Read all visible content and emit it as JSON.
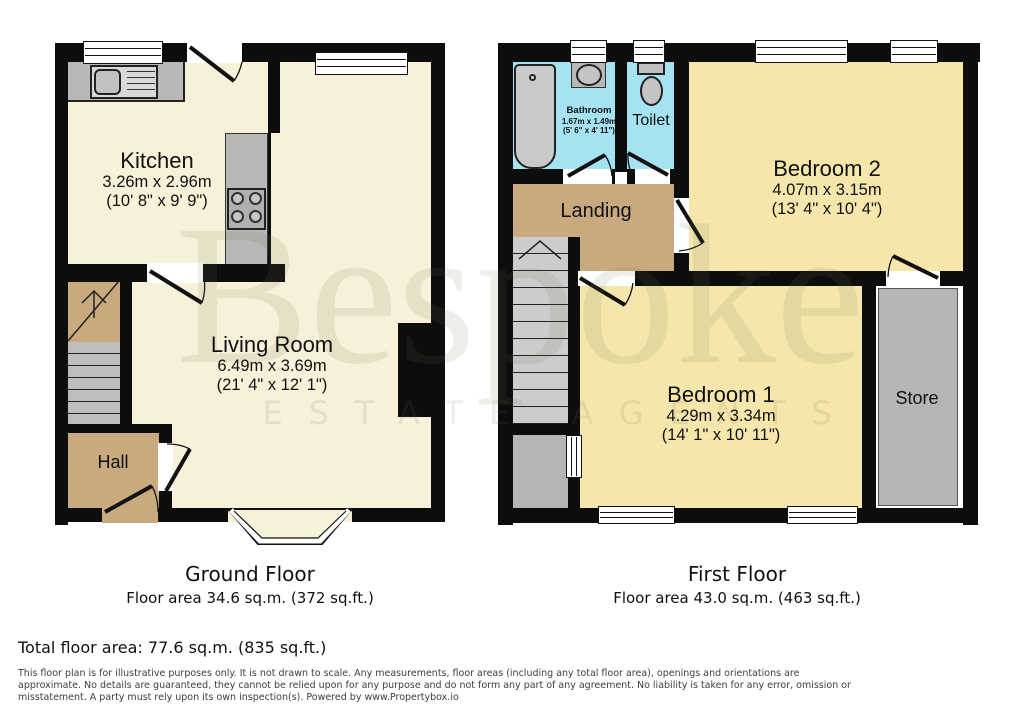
{
  "watermark": {
    "brand": "Bespoke",
    "tagline": "ESTATE AGENTS"
  },
  "ground_floor": {
    "title": "Ground Floor",
    "area": "Floor area 34.6 sq.m. (372 sq.ft.)",
    "rooms": {
      "kitchen": {
        "name": "Kitchen",
        "dim_m": "3.26m x 2.96m",
        "dim_ft": "(10' 8\" x 9' 9\")"
      },
      "living": {
        "name": "Living Room",
        "dim_m": "6.49m x 3.69m",
        "dim_ft": "(21' 4\" x 12' 1\")"
      },
      "hall": {
        "name": "Hall"
      }
    }
  },
  "first_floor": {
    "title": "First Floor",
    "area": "Floor area 43.0 sq.m. (463 sq.ft.)",
    "rooms": {
      "bathroom": {
        "name": "Bathroom",
        "dim_m": "1.67m x 1.49m",
        "dim_ft": "(5' 6\" x 4' 11\")"
      },
      "toilet": {
        "name": "Toilet"
      },
      "landing": {
        "name": "Landing"
      },
      "bedroom2": {
        "name": "Bedroom 2",
        "dim_m": "4.07m x 3.15m",
        "dim_ft": "(13' 4\" x 10' 4\")"
      },
      "bedroom1": {
        "name": "Bedroom 1",
        "dim_m": "4.29m x 3.34m",
        "dim_ft": "(14' 1\" x 10' 11\")"
      },
      "store": {
        "name": "Store"
      }
    }
  },
  "summary": {
    "total": "Total floor area: 77.6 sq.m. (835 sq.ft.)"
  },
  "disclaimer_lines": [
    "This floor plan is for illustrative purposes only. It is not drawn to scale. Any measurements, floor areas (including any total floor area), openings and orientations are",
    "approximate. No details are guaranteed, they cannot be relied upon for any purpose and do not form any part of any agreement. No liability is taken for any error, omission or",
    "misstatement. A party must rely upon its own inspection(s). Powered by www.Propertybox.io"
  ],
  "colors": {
    "wall": "#0d0d0d",
    "room_cream": "#f6f1d8",
    "bedroom_yellow": "#f5e6ab",
    "hall_tan": "#c9a97e",
    "bathroom_blue": "#a5e2f2",
    "fixture_gray": "#b8b8b8",
    "stairs_gray": "#c6c6c6",
    "store_gray": "#b5b5b5"
  }
}
